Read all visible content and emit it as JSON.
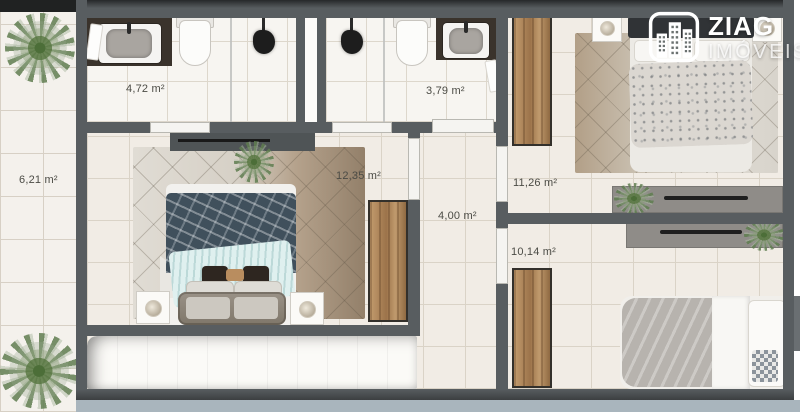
{
  "logo": {
    "brand_top": "ZIAG",
    "brand_bottom": "IMÓVEIS"
  },
  "rooms": {
    "balcony": {
      "area": "6,21 m²"
    },
    "bathroom_1": {
      "area": "4,72 m²"
    },
    "bathroom_2": {
      "area": "3,79 m²"
    },
    "master_bedroom": {
      "area": "12,35 m²"
    },
    "hallway": {
      "area": "4,00 m²"
    },
    "bedroom_2": {
      "area": "11,26 m²"
    },
    "bedroom_3": {
      "area": "10,14 m²"
    }
  },
  "icons": {
    "logo_badge": "buildings-icon",
    "plants": "plant-icon"
  },
  "colors": {
    "wall": "#585d60",
    "floor": "#f1ece5",
    "balcony_floor": "#f4f1ec",
    "dark_counter": "#3a332c",
    "wood": "#b08a5f",
    "bottom_bar": "#a9b5bd",
    "logo_text": "#ffffff"
  }
}
